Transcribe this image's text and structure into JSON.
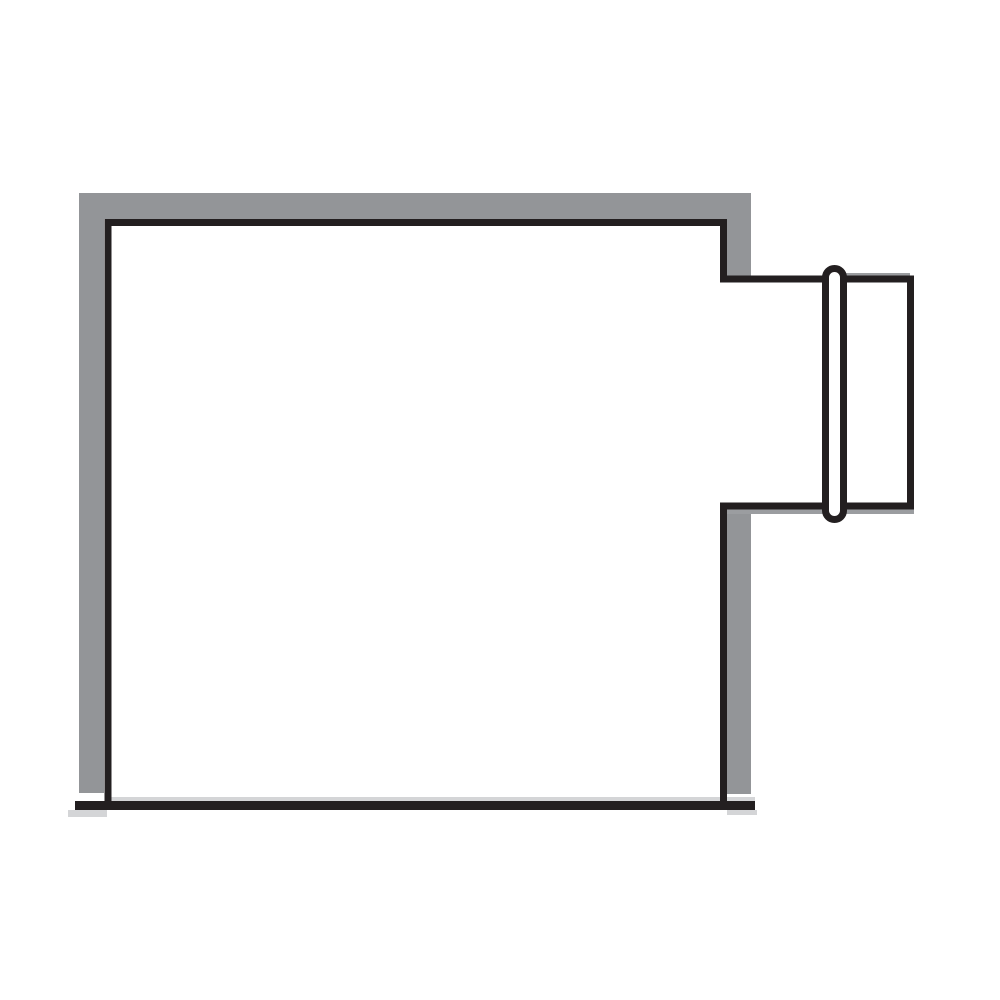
{
  "diagram": {
    "name": "duct-fitting-line-drawing",
    "figure": "rectangular-plenum-box-with-side-collar-and-bead",
    "parts": [
      "plenum-box-body",
      "gray-shadow-band",
      "right-side-notch",
      "takeoff-collar",
      "collar-bead-gasket",
      "base-line"
    ]
  },
  "colors": {
    "background": "#ffffff",
    "ink": "#231f20",
    "band": "#939598",
    "collar_shadow": "#9b9da0",
    "base_shadow": "#d4d5d7",
    "fill": "#ffffff"
  }
}
